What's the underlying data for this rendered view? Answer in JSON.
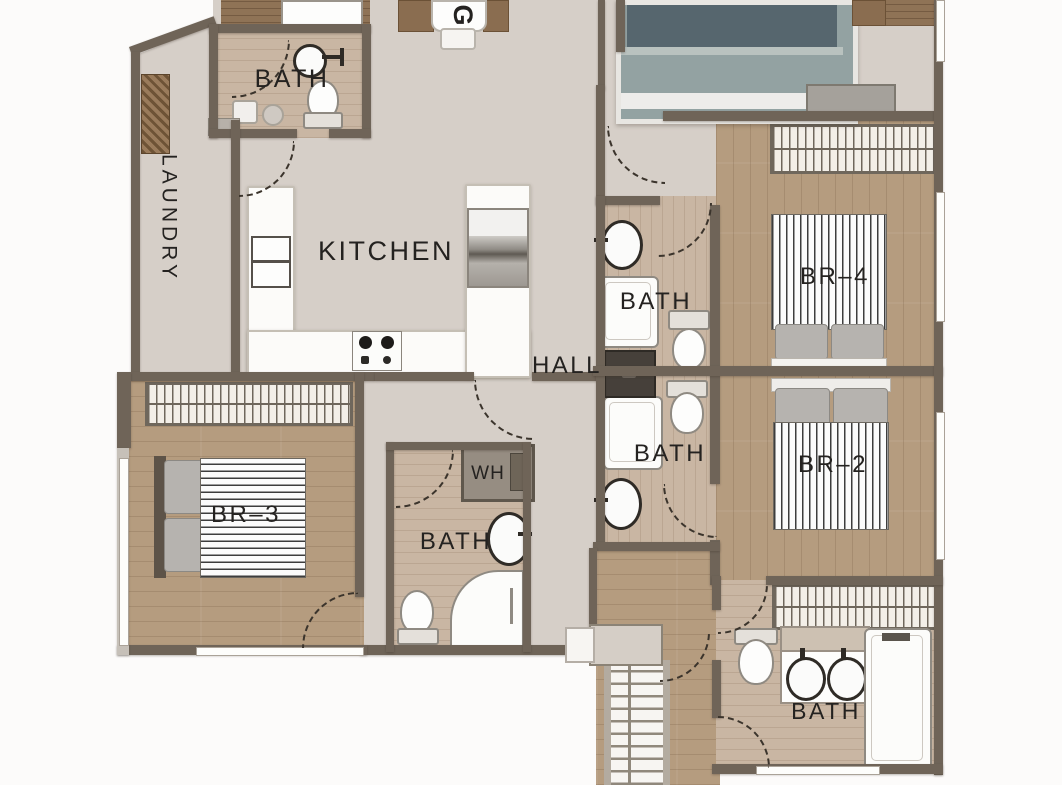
{
  "plan_type": "apartment floor plan",
  "labels": {
    "dining_partial": "G",
    "bath_top_left": "BATH",
    "laundry": "LAUNDRY",
    "kitchen": "KITCHEN",
    "hall": "HALL",
    "bath_hall_upper": "BATH",
    "bath_hall_lower": "BATH",
    "water_heater": "WH",
    "bath_center_bottom": "BATH",
    "bath_ensuite": "BATH",
    "bedroom_4": "BR–4",
    "bedroom_2": "BR–2",
    "bedroom_3": "BR–3"
  },
  "rooms": [
    {
      "name": "laundry",
      "label": "LAUNDRY"
    },
    {
      "name": "bath-top-left",
      "label": "BATH",
      "fixtures": [
        "sink",
        "toilet"
      ]
    },
    {
      "name": "kitchen",
      "label": "KITCHEN",
      "fixtures": [
        "double-sink",
        "cooktop",
        "refrigerator",
        "u-shaped-counter"
      ]
    },
    {
      "name": "hall",
      "label": "HALL"
    },
    {
      "name": "bath-hall-upper",
      "label": "BATH",
      "fixtures": [
        "sink",
        "bathtub",
        "toilet"
      ]
    },
    {
      "name": "bath-hall-lower",
      "label": "BATH",
      "fixtures": [
        "sink",
        "bathtub",
        "toilet"
      ]
    },
    {
      "name": "water-heater-closet",
      "label": "WH"
    },
    {
      "name": "bath-center-bottom",
      "label": "BATH",
      "fixtures": [
        "sink",
        "toilet",
        "shower"
      ]
    },
    {
      "name": "bedroom-4",
      "label": "BR–4",
      "fixtures": [
        "double-bed",
        "closet",
        "dresser"
      ]
    },
    {
      "name": "bedroom-2",
      "label": "BR–2",
      "fixtures": [
        "double-bed",
        "closet"
      ]
    },
    {
      "name": "bedroom-3",
      "label": "BR–3",
      "fixtures": [
        "double-bed",
        "closet"
      ]
    },
    {
      "name": "bath-ensuite",
      "label": "BATH",
      "fixtures": [
        "double-vanity",
        "toilet",
        "bathtub",
        "closet"
      ]
    },
    {
      "name": "dining",
      "label": "G",
      "fixtures": [
        "table",
        "chairs"
      ]
    },
    {
      "name": "master-bedroom-partial",
      "fixtures": [
        "double-bed",
        "nightstand",
        "dresser"
      ]
    },
    {
      "name": "stairs"
    }
  ],
  "colors": {
    "outside": "#fcfbfa",
    "wall": "#6f6458",
    "floor_hall": "#d6cfc8",
    "floor_wood": "#b59c7f",
    "floor_wood_light": "#c9b6a3",
    "fixture": "#fcfcfa",
    "label_text": "#242220"
  }
}
